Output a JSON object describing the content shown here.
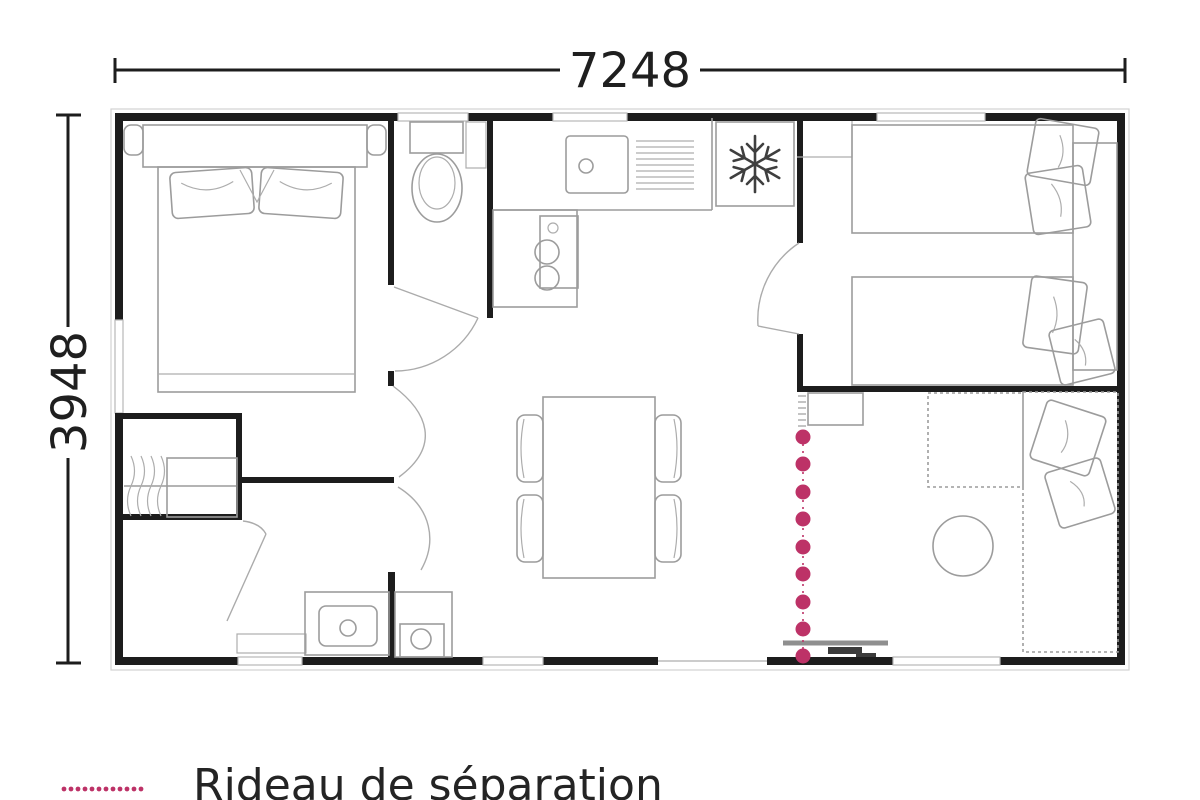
{
  "diagram": {
    "type": "floor-plan",
    "subject": "mobile-home layout"
  },
  "dimensions": {
    "width_label": "7248",
    "height_label": "3948"
  },
  "legend": {
    "curtain_label": "Rideau de séparation",
    "curtain_swatch": "pink-dotted-line"
  },
  "colors": {
    "wall": "#1d1d1d",
    "furniture_outline": "#9c9c9c",
    "curtain": "#bd3267",
    "text": "#242424",
    "background": "#ffffff"
  },
  "icons": {
    "fridge": "snowflake-icon",
    "curtain": "dotted-line-icon"
  },
  "objects": [
    "double-bed",
    "pillows",
    "toilet",
    "wash-basin",
    "kitchen-sink",
    "drainer",
    "fridge",
    "hob",
    "dining-table",
    "four-chairs",
    "twin-bed",
    "twin-bed",
    "headboard-panel",
    "wardrobe",
    "shower-sink",
    "water-heater",
    "bench-sofa",
    "round-table",
    "cushions",
    "entrance-door",
    "separation-curtain",
    "interior-doors",
    "windows"
  ]
}
